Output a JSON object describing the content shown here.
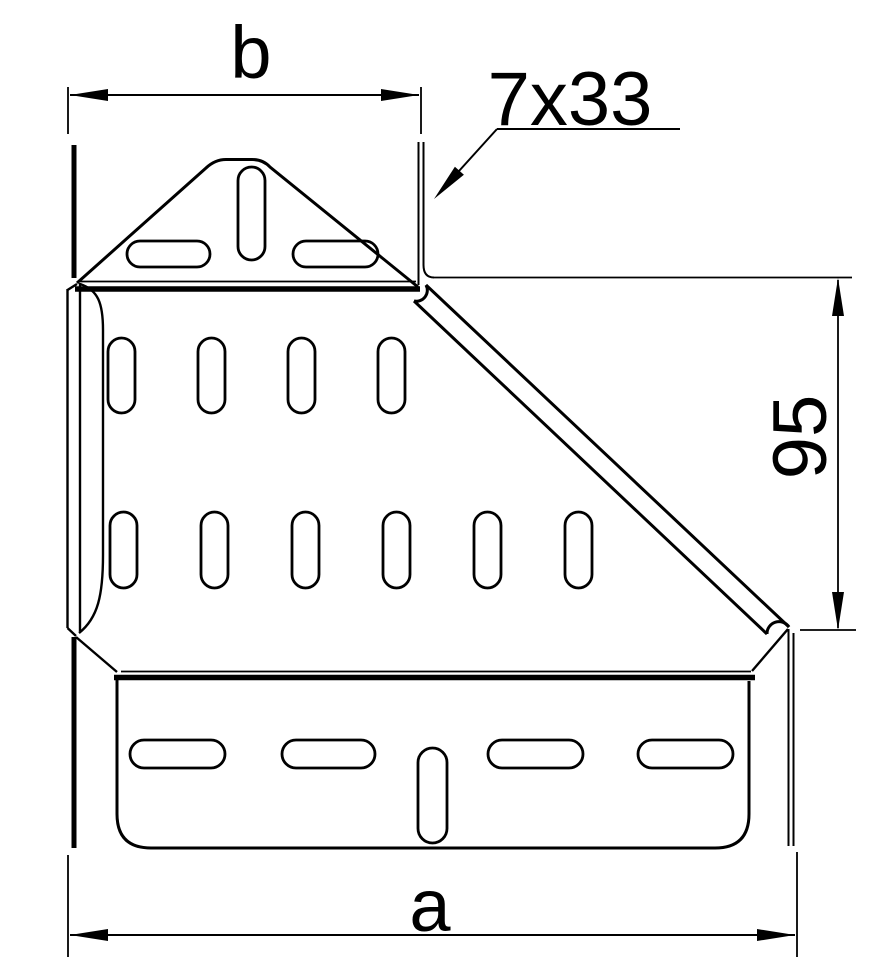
{
  "drawing": {
    "type": "technical-drawing-cable-tray-reducer-top-view",
    "dimensions": {
      "top_width_label": "b",
      "bottom_width_label": "a",
      "right_height_label": "95",
      "slot_size_label": "7x33"
    },
    "colors": {
      "line": "#000000",
      "background": "#ffffff"
    }
  }
}
